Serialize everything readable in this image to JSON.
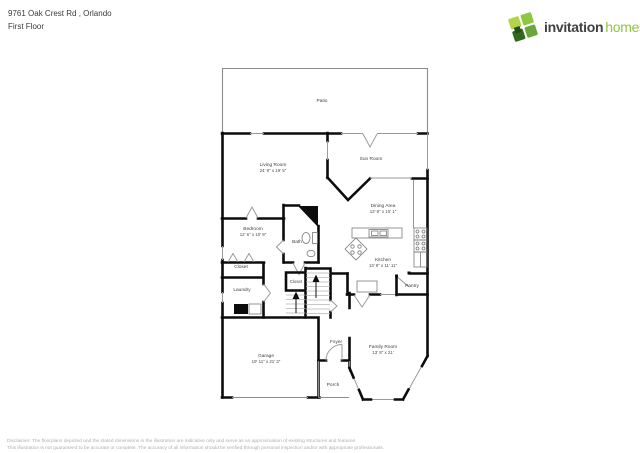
{
  "header": {
    "address": "9761 Oak Crest Rd , Orlando",
    "floor": "First Floor"
  },
  "logo": {
    "name_part1": "invitation",
    "name_part2": "homes",
    "trademark": "™",
    "colors": {
      "brand_green": "#8dc63f",
      "brand_dark": "#414042",
      "leaf_light": "#b2d34a",
      "leaf_bright": "#8dc63f",
      "leaf_mid": "#6aa63a",
      "leaf_dark": "#33691e"
    }
  },
  "floorplan": {
    "wall_color": "#0c0c0c",
    "window_color": "#9a9a9a",
    "rooms": [
      {
        "name": "Patio"
      },
      {
        "name": "Living Room",
        "dims": "24' 8\" x 19' 5\""
      },
      {
        "name": "Sun Room"
      },
      {
        "name": "Dining Area",
        "dims": "13' 9\" x 10' 1\""
      },
      {
        "name": "Bedroom",
        "dims": "12' 6\" x 10' 9\""
      },
      {
        "name": "Bath"
      },
      {
        "name": "Closet"
      },
      {
        "name": "Laundry"
      },
      {
        "name": "Closet"
      },
      {
        "name": "Kitchen",
        "dims": "13' 9\" x 11' 11\""
      },
      {
        "name": "Pantry"
      },
      {
        "name": "Foyer"
      },
      {
        "name": "Family Room",
        "dims": "13' 8\" x 21'"
      },
      {
        "name": "Garage",
        "dims": "19' 11\" x 21' 3\""
      },
      {
        "name": "Porch"
      }
    ]
  },
  "disclaimer": {
    "line1": "Disclaimer: The floorplans depicted and the stated dimensions in the illustration are indicative only and serve as an approximation of existing structures and features",
    "line2": "This illustration is not guaranteed to be accurate or complete. The accuracy of all information should be verified through personal inspection and/or with appropriate professionals."
  }
}
